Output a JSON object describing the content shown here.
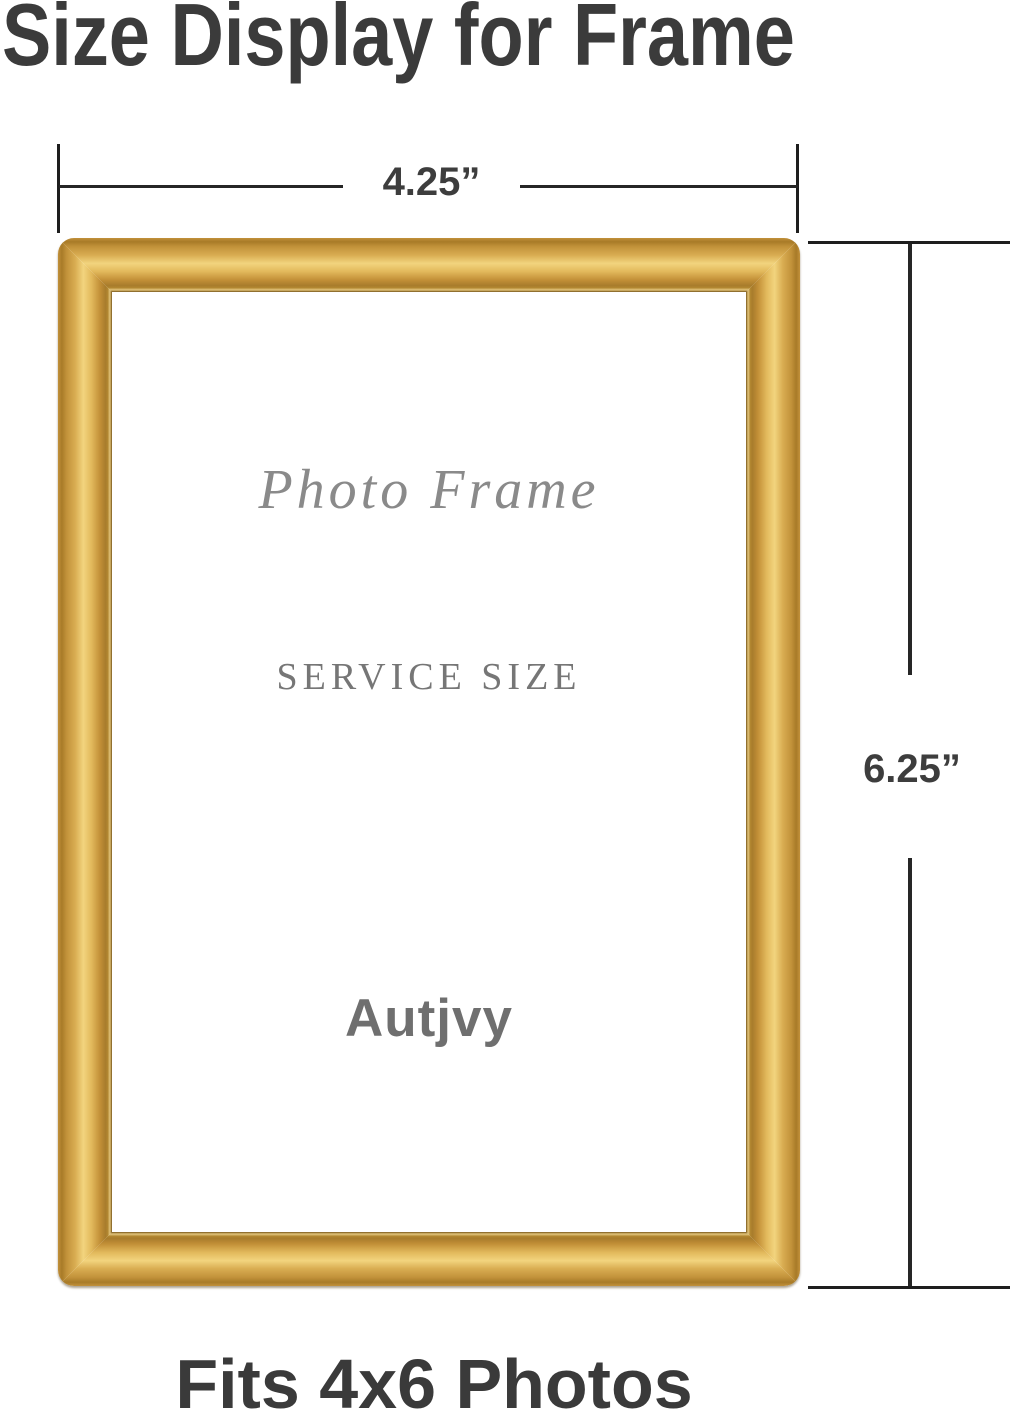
{
  "header": {
    "title": "Size Display for Frame"
  },
  "dimensions": {
    "width_label": "4.25”",
    "height_label": "6.25”"
  },
  "frame": {
    "script_text": "Photo Frame",
    "service_text": "SERVICE SIZE",
    "brand_text": "Autjvy"
  },
  "footer": {
    "caption": "Fits 4x6 Photos"
  },
  "colors": {
    "heading_text": "#3b3b3b",
    "dimension_line": "#262626",
    "dimension_text": "#3d3d3d",
    "frame_gold_dark": "#a87b28",
    "frame_gold_mid": "#d9ad52",
    "frame_gold_highlight": "#f2d47e",
    "inner_text_gray": "#8a8a8a",
    "footer_text": "#3a3a3a"
  }
}
